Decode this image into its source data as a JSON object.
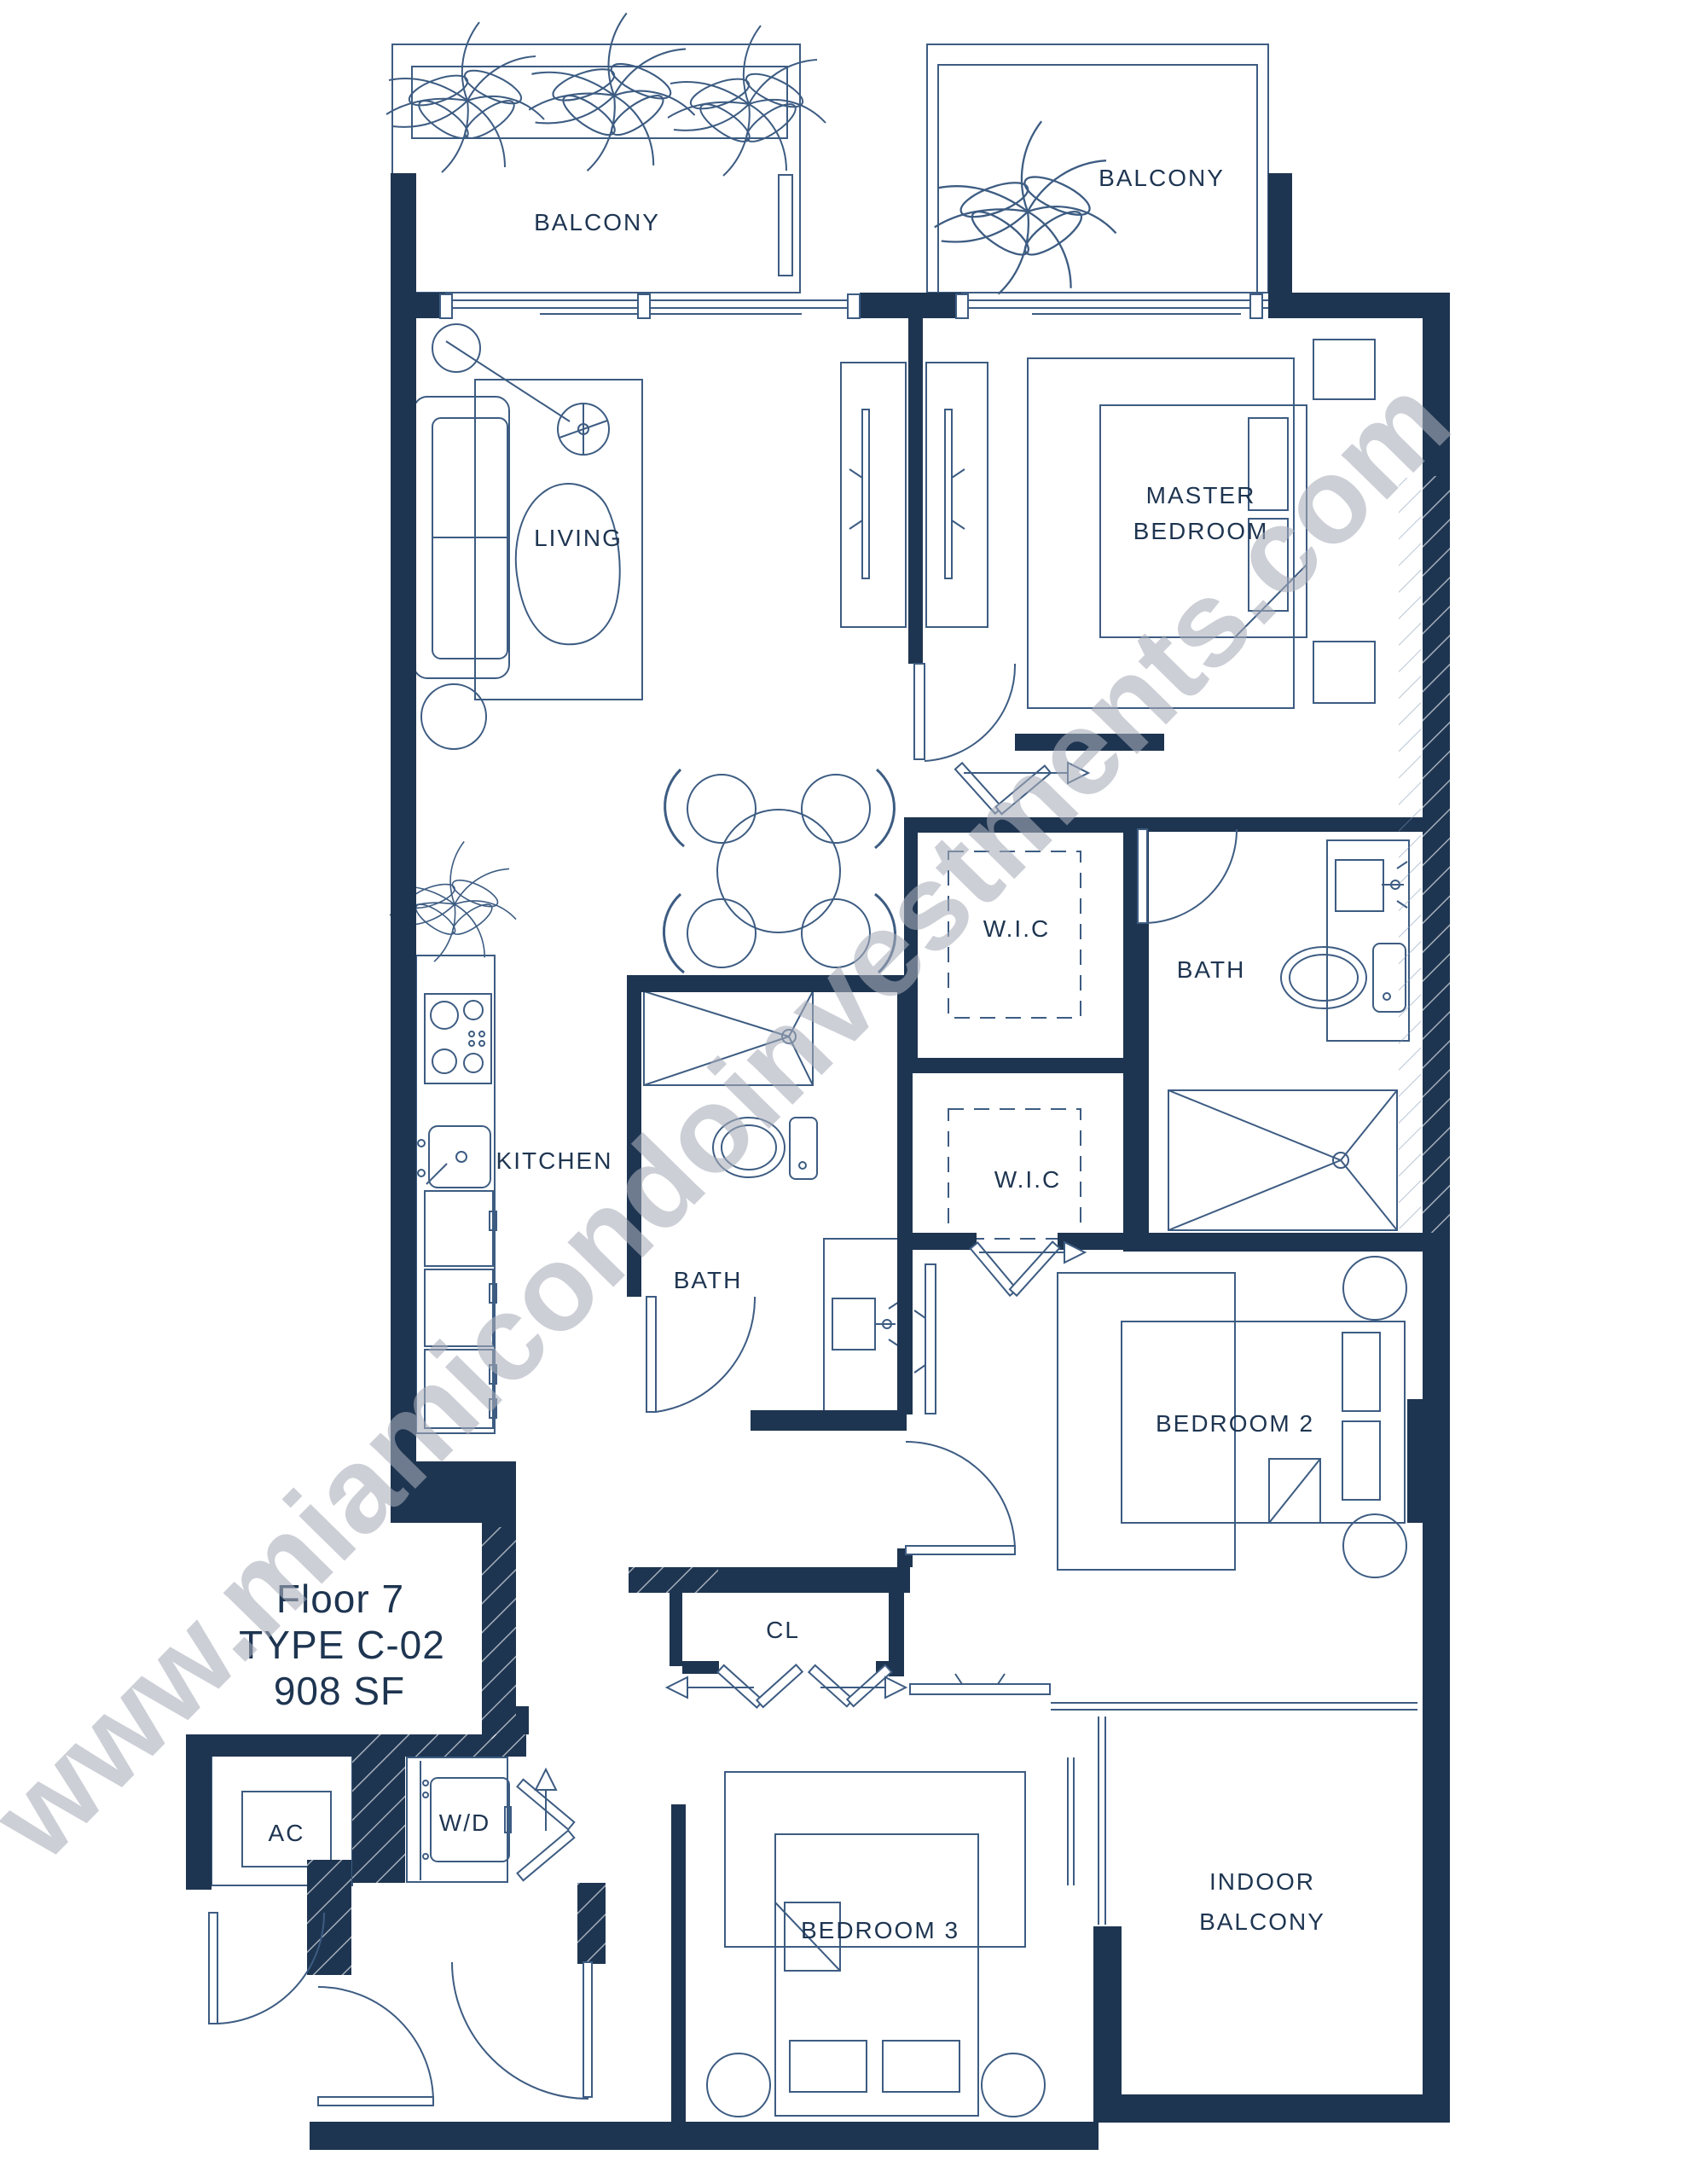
{
  "plan": {
    "title_block": {
      "floor": "Floor 7",
      "type": "TYPE C-02",
      "area": "908 SF"
    },
    "watermark": "www.miamicondoinvestments.com",
    "rooms": {
      "balcony_top_left": "BALCONY",
      "balcony_top_right": "BALCONY",
      "living": "LIVING",
      "master_line1": "MASTER",
      "master_line2": "BEDROOM",
      "wic_master": "W.I.C",
      "bath_master": "BATH",
      "kitchen": "KITCHEN",
      "bath_2": "BATH",
      "wic_2": "W.I.C",
      "bedroom_2": "BEDROOM 2",
      "closet": "CL",
      "ac_closet": "AC",
      "washer_dryer": "W/D",
      "bedroom_3": "BEDROOM 3",
      "indoor_line1": "INDOOR",
      "indoor_line2": "BALCONY"
    },
    "colors": {
      "walls": "#1E3551",
      "lines": "#3D5C82",
      "labels": "#1E3551",
      "watermark": "#A9AEBA",
      "background": "#FFFFFF"
    }
  }
}
